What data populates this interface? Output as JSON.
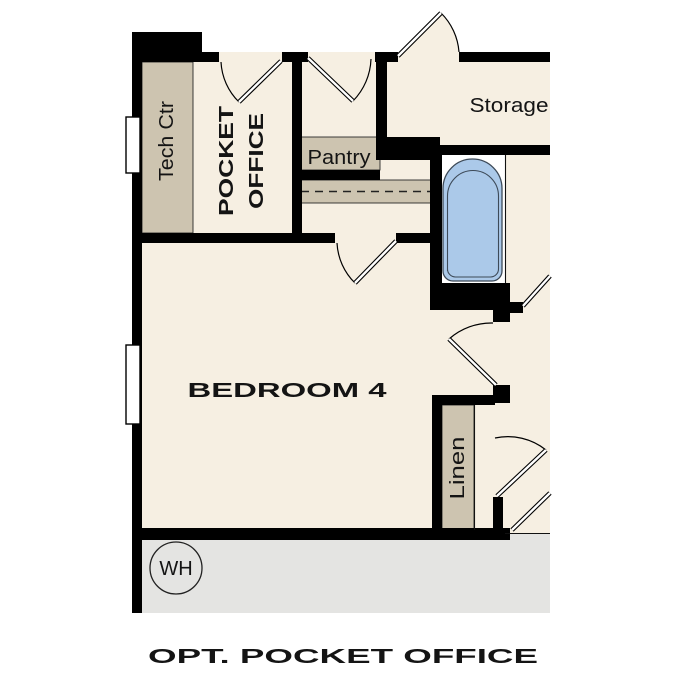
{
  "caption": "OPT. POCKET OFFICE",
  "labels": {
    "tech_ctr": "Tech Ctr",
    "pocket_office_1": "POCKET",
    "pocket_office_2": "OFFICE",
    "pantry": "Pantry",
    "storage": "Storage",
    "bedroom": "BEDROOM 4",
    "linen": "Linen",
    "water_heater": "WH"
  },
  "colors": {
    "floor": "#f6efe2",
    "cabinet": "#cdc4b0",
    "tub": "#abc9e9",
    "tubline": "#3d4a58",
    "garage": "#e4e4e2",
    "wall": "#000000",
    "ink": "#141414",
    "page": "#ffffff"
  }
}
